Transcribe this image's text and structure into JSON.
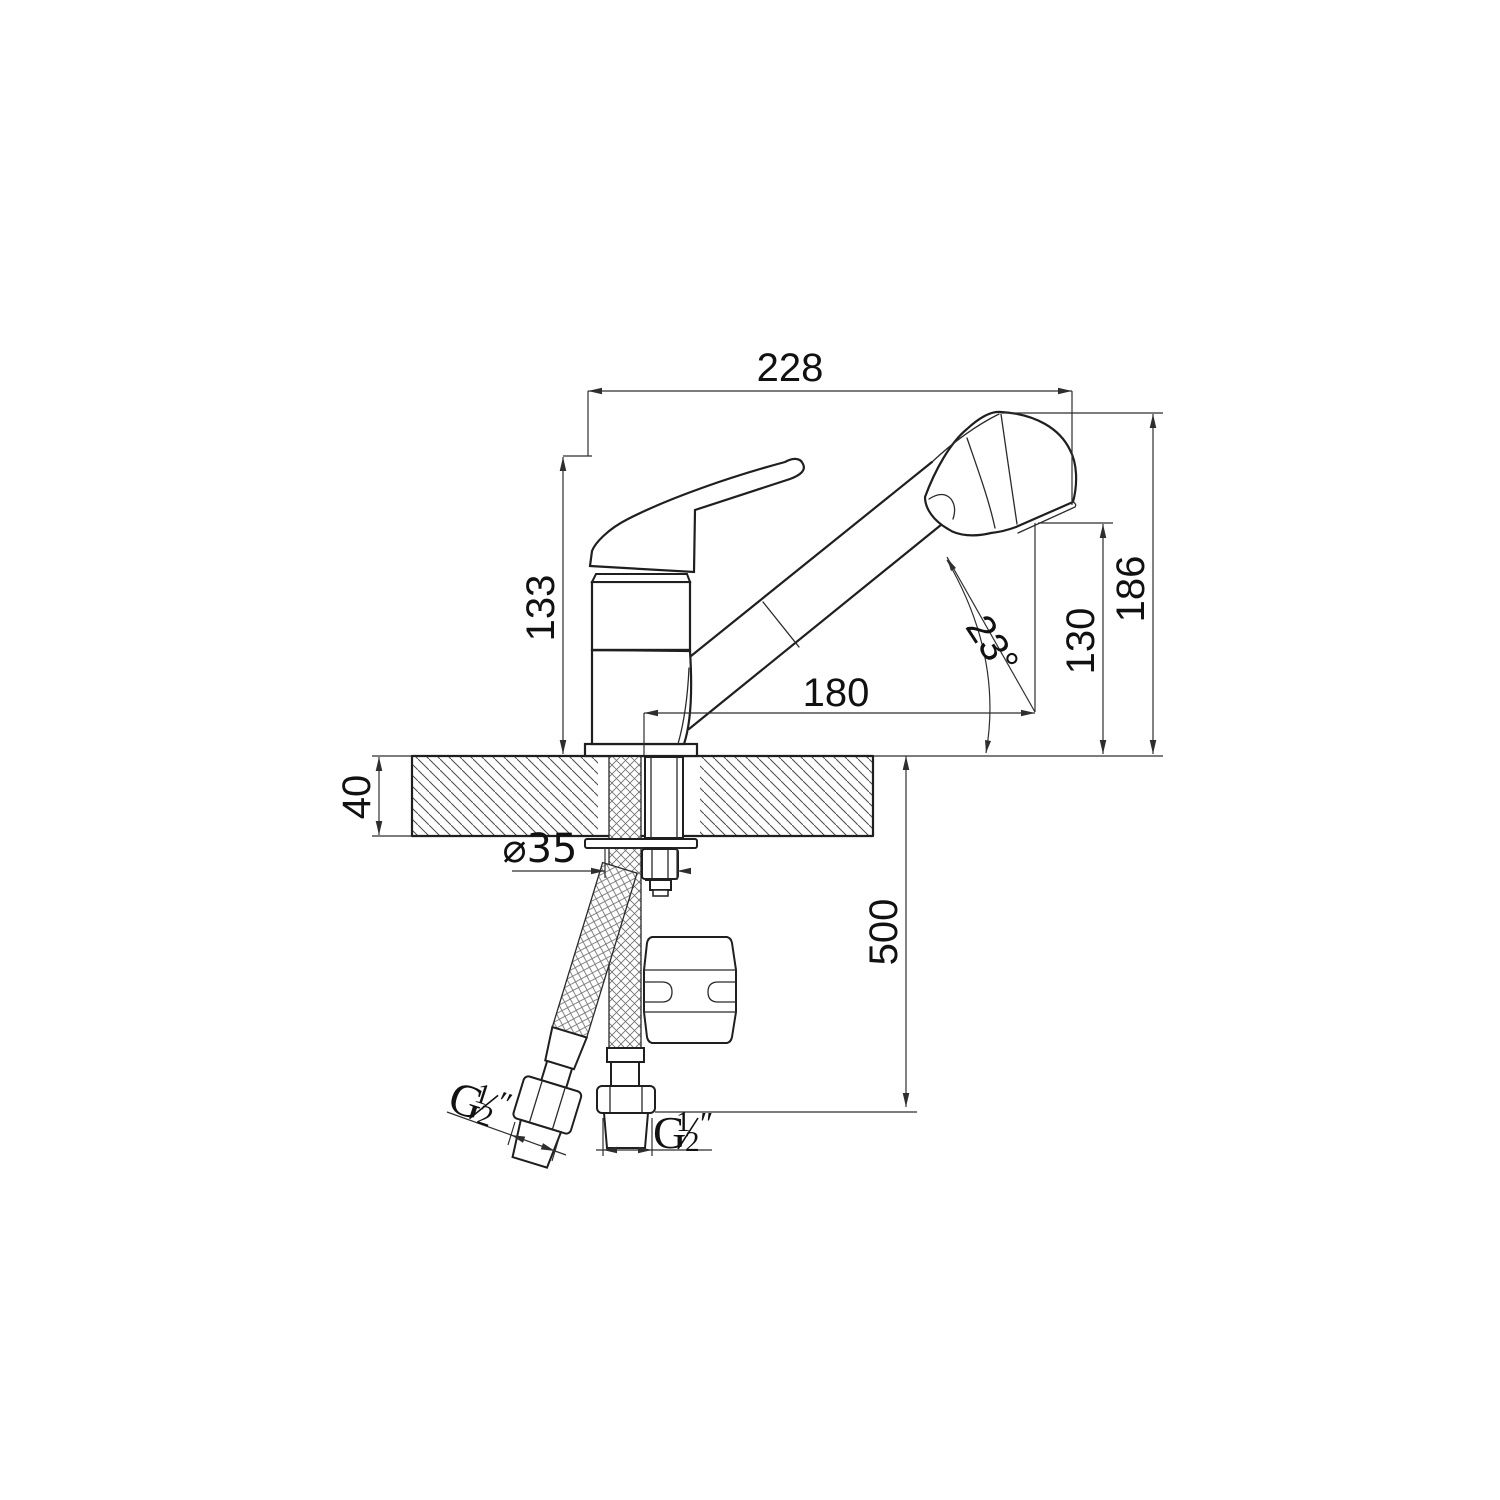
{
  "page": {
    "background": "#ffffff"
  },
  "drawing": {
    "type": "technical-drawing",
    "subject": "Single-lever kitchen mixer faucet with pull-out spray head, side elevation with installation dimensions",
    "line_color": "#1f1f1f",
    "dim_color": "#2e2e2e"
  },
  "dimensions": {
    "overall_width": "228",
    "body_height": "133",
    "overall_height": "186",
    "outlet_height": "130",
    "spout_reach": "180",
    "spray_angle": "23°",
    "deck_thickness": "40",
    "hole_diameter": "⌀35",
    "hose_length": "500",
    "thread_label": {
      "g": "G",
      "numerator": "1",
      "denominator": "2",
      "unit": "″"
    }
  }
}
